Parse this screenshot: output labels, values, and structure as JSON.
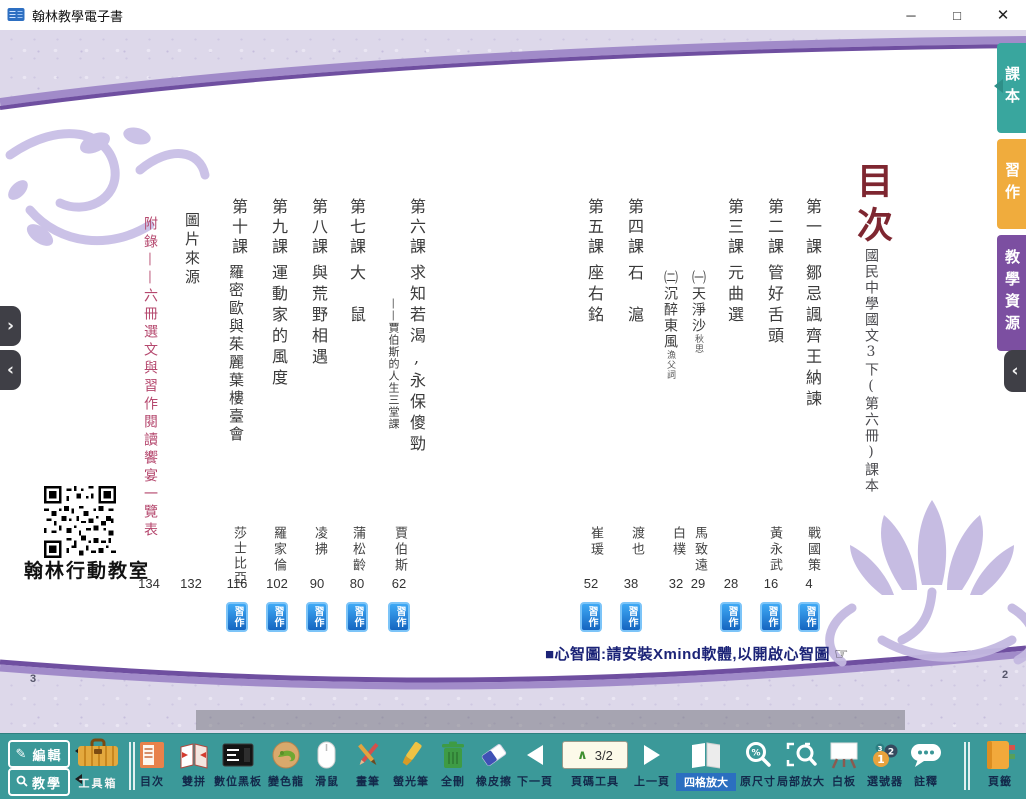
{
  "window": {
    "title": "翰林教學電子書",
    "minimize": "─",
    "maximize": "□",
    "close": "✕"
  },
  "side_tabs": [
    {
      "label": "課本",
      "selected": true
    },
    {
      "label": "習作",
      "selected": false
    },
    {
      "label": "教學資源",
      "selected": false
    }
  ],
  "colors": {
    "tab_textbook": "#39A69E",
    "tab_workbook": "#F0AC3D",
    "tab_resources": "#7C4FA1",
    "toolbar_teal": "#3B9999",
    "badge_blue": "#1E88E5",
    "title_red": "#7E2630",
    "appendix_pink": "#B5486E",
    "note_navy": "#1B2377"
  },
  "page": {
    "title": "目次",
    "subtitle": "國民中學國文3下(第六冊)課本",
    "workbook_badge": "習作",
    "note": "■心智圖:請安裝Xmind軟體,以開啟心智圖",
    "hand_glyph": "☞",
    "qr_caption": "翰林行動教室",
    "left_page_number": "3",
    "right_page_number": "2",
    "lessons": [
      {
        "label": "第一課",
        "title": "鄒忌諷齊王納諫",
        "author": "戰國策",
        "page": "4"
      },
      {
        "label": "第二課",
        "title": "管好舌頭",
        "author": "黃永武",
        "page": "16"
      },
      {
        "label": "第三課",
        "title": "元曲選",
        "page": "28",
        "subitems": [
          {
            "no": "㈠",
            "title": "天淨沙",
            "note": "秋思",
            "author": "馬致遠",
            "page": "29"
          },
          {
            "no": "㈡",
            "title": "沉醉東風",
            "note": "漁父詞",
            "author": "白樸",
            "page": "32"
          }
        ]
      },
      {
        "label": "第四課",
        "title": "石　滬",
        "author": "渡也",
        "page": "38"
      },
      {
        "label": "第五課",
        "title": "座右銘",
        "author": "崔瑗",
        "page": "52"
      },
      {
        "label": "第六課",
        "title": "求知若渴,永保傻勁",
        "subtitle": "——賈伯斯的人生三堂課",
        "author": "賈伯斯",
        "page": "62"
      },
      {
        "label": "第七課",
        "title": "大　鼠",
        "author": "蒲松齡",
        "page": "80"
      },
      {
        "label": "第八課",
        "title": "與荒野相遇",
        "author": "凌拂",
        "page": "90"
      },
      {
        "label": "第九課",
        "title": "運動家的風度",
        "author": "羅家倫",
        "page": "102"
      },
      {
        "label": "第十課",
        "title": "羅密歐與茱麗葉樓臺會",
        "author": "莎士比亞",
        "page": "116"
      },
      {
        "label": "圖片來源",
        "page": "132"
      },
      {
        "label": "附錄——六冊選文與習作閱讀饗宴一覽表",
        "page": "134"
      }
    ]
  },
  "left_nav": {
    "expand": "›",
    "collapse": "‹"
  },
  "right_nav": {
    "collapse": "‹"
  },
  "toolbar": {
    "edit": "編輯",
    "teach": "教學",
    "toolbox": "工具箱",
    "pencil_glyph": "✎",
    "page_counter": "3/2",
    "caret": "∧",
    "tools": [
      {
        "label": "目次"
      },
      {
        "label": "雙拼"
      },
      {
        "label": "數位黑板"
      },
      {
        "label": "變色龍"
      },
      {
        "label": "滑鼠"
      },
      {
        "label": "畫筆"
      },
      {
        "label": "螢光筆"
      },
      {
        "label": "全刪"
      },
      {
        "label": "橡皮擦"
      },
      {
        "label": "下一頁"
      },
      {
        "label": "頁碼工具"
      },
      {
        "label": "上一頁"
      },
      {
        "label": "四格放大",
        "selected": true
      },
      {
        "label": "原尺寸"
      },
      {
        "label": "局部放大"
      },
      {
        "label": "白板"
      },
      {
        "label": "選號器"
      },
      {
        "label": "註釋"
      },
      {
        "label": "頁籤"
      }
    ]
  }
}
